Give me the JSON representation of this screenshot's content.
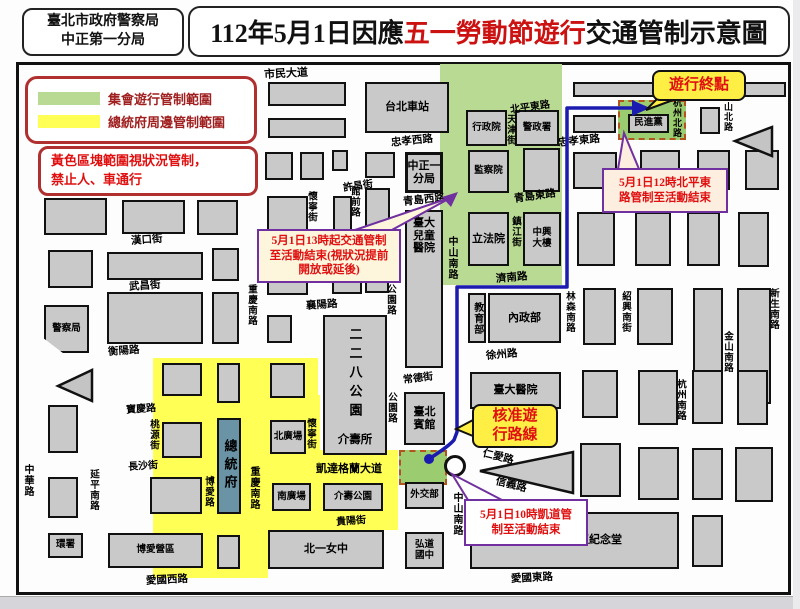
{
  "header": {
    "agency_line1": "臺北市政府警察局",
    "agency_line2": "中正第一分局",
    "title_prefix": "112年5月1日因應",
    "title_highlight": "五一勞動節遊行",
    "title_suffix": "交通管制示意圖"
  },
  "legend": {
    "green_label": "集會遊行管制範圍",
    "yellow_label": "總統府周邊管制範圍",
    "note_line1": "黃色區塊範圍視狀況管制，",
    "note_line2": "禁止人、車通行"
  },
  "callouts": {
    "end_point": "遊行終點",
    "north_line1": "5月1日12時北平東",
    "north_line2": "路管制至活動結束",
    "west_line1": "5月1日13時起交通管制",
    "west_line2": "至活動結束(視狀況提前",
    "west_line3": "開放或延後)",
    "route_line1": "核准遊",
    "route_line2": "行路線",
    "south_line1": "5月1日10時凱道管",
    "south_line2": "制至活動結束"
  },
  "streets": {
    "shimin": "市民大道",
    "zhongxiao_w": "忠孝西路",
    "beiping_e": "北平東路",
    "tianjin": "天津街",
    "zhongxiao_e": "忠孝東路",
    "hangzhou_n": "杭州北路",
    "jinshan_n": "金山北路",
    "qingdao_w": "青島西路",
    "qingdao_e": "青島東路",
    "zhenjiang": "鎮江街",
    "jinan": "濟南路",
    "linsen_s": "林森南路",
    "shaoxing_s": "紹興南街",
    "xinsheng_s": "新生南路",
    "jinshan_s": "金山南路",
    "hangzhou_s": "杭州南路",
    "xuzhou": "徐州路",
    "changde": "常德街",
    "gongyuan": "公園路",
    "zhongshan_s": "中山南路",
    "kaifeng": "開封街",
    "hankou": "漢口街",
    "wuchang": "武昌街",
    "hengyang": "衡陽路",
    "xiangyang": "襄陽路",
    "baoqing": "寶慶路",
    "taoyuan": "桃源街",
    "changsha": "長沙街",
    "yanping_s": "延平南路",
    "zhonghua": "中華路",
    "boai_rd": "博愛路",
    "chongqing_s": "重慶南路",
    "huaining": "懷寧街",
    "guanqian": "館前路",
    "xuchang": "許昌街",
    "ketagalan": "凱達格蘭大道",
    "guiyang": "貴陽街",
    "renai": "仁愛路",
    "xinyi": "信義路",
    "aiguo_w": "愛國西路",
    "aiguo_e": "愛國東路"
  },
  "buildings": {
    "station": [
      "台北車站"
    ],
    "branch": [
      "中正一",
      "分局"
    ],
    "ntuch": [
      "臺大",
      "兒童",
      "醫院"
    ],
    "guest": [
      "臺北",
      "賓館"
    ],
    "mofa": [
      "外交部"
    ],
    "hongdao": [
      "弘道",
      "國中"
    ],
    "xing": [
      "行政院"
    ],
    "jing": [
      "警政署"
    ],
    "jian": [
      "監察院"
    ],
    "li": [
      "立法院"
    ],
    "zhongxing": [
      "中興",
      "大樓"
    ],
    "moe": [
      "教育部"
    ],
    "moi": [
      "內政部"
    ],
    "ntuh": [
      "臺大醫院"
    ],
    "dpp": [
      "民進黨"
    ],
    "police": [
      "警察局"
    ],
    "pres": [
      "總統府"
    ],
    "np": [
      "北廣場"
    ],
    "sp": [
      "南廣場"
    ],
    "jspark": [
      "介壽公園"
    ],
    "beiyi": [
      "北一女中"
    ],
    "boai": [
      "博愛營區"
    ],
    "huan": [
      "環署"
    ],
    "cks": [
      "中正紀念堂"
    ],
    "p228": [
      "二二八公園"
    ],
    "jssuo": [
      "介壽所"
    ]
  },
  "colors": {
    "green_zone": "#b9da92",
    "yellow_zone": "#ffff55",
    "rally_green": "#9ccc70",
    "route_blue": "#1b1bb0",
    "callout_purple": "#7030a0"
  }
}
